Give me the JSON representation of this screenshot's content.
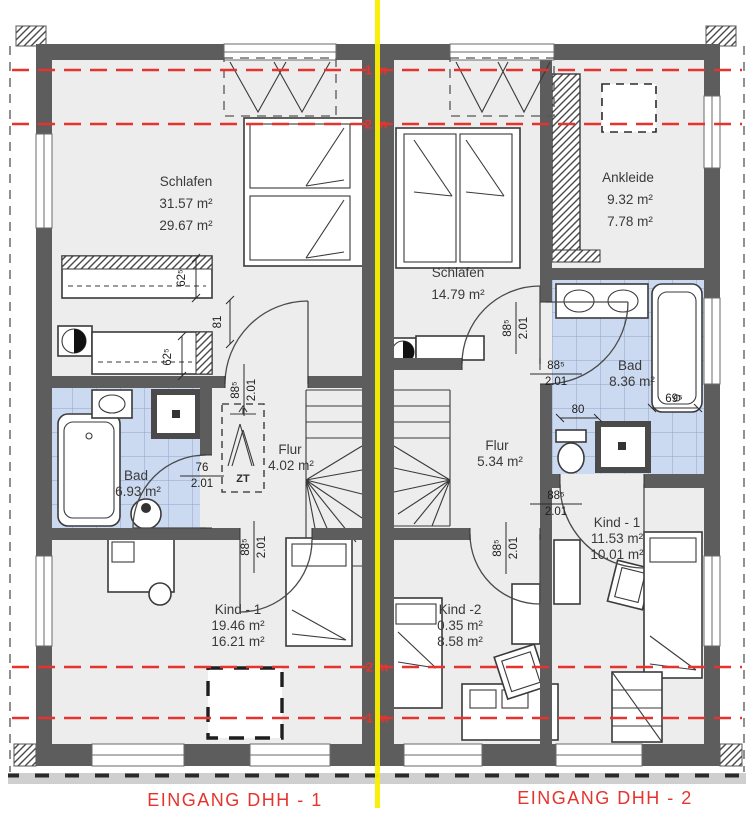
{
  "captions": {
    "left": "EINGANG  DHH - 1",
    "right": "EINGANG  DHH - 2"
  },
  "rooms": {
    "schlafen1": {
      "name": "Schlafen",
      "line2": "31.57 m²",
      "line3": "29.67 m²"
    },
    "ankleide": {
      "name": "Ankleide",
      "line2": "9.32 m²",
      "line3": "7.78 m²"
    },
    "schlafen2": {
      "name": "Schlafen",
      "line2": "14.79 m²"
    },
    "bad1": {
      "name": "Bad",
      "line2": "6.93 m²"
    },
    "bad2": {
      "name": "Bad",
      "line2": "8.36 m²"
    },
    "flur1": {
      "name": "Flur",
      "line2": "4.02 m²"
    },
    "flur2": {
      "name": "Flur",
      "line2": "5.34 m²"
    },
    "kind1_left": {
      "name": "Kind - 1",
      "line2": "19.46 m²",
      "line3": "16.21 m²"
    },
    "kind2": {
      "name": "Kind -2",
      "line2": "0.35 m²",
      "line3": "8.58 m²"
    },
    "kind1_right": {
      "name": "Kind  - 1",
      "line2": "11.53 m²",
      "line3": "10.01 m²"
    }
  },
  "dims": {
    "schlafen1_door": {
      "a": "88⁵",
      "b": "2.01"
    },
    "kind1l_door": {
      "a": "88⁵",
      "b": "2.01"
    },
    "bad1_door": {
      "a": "76",
      "b": "2.01"
    },
    "wall_81": "81",
    "wardrobe1_62": "62⁵",
    "wardrobe2_62": "62⁵",
    "schlafen2_door": {
      "a": "88⁵",
      "b": "2.01"
    },
    "bad2_door": {
      "a": "88⁵",
      "b": "2.01"
    },
    "bad2_80": "80",
    "bad2_69": "69⁵",
    "kind1r_door": {
      "a": "88⁵",
      "b": "2.01"
    },
    "kind2_door": {
      "a": "88⁵",
      "b": "2.01"
    }
  },
  "height_marks": {
    "top_1m": "1 m",
    "top_2m": "2 m",
    "bottom_2m": "2 m",
    "bottom_1m": "1 m"
  },
  "symbols": {
    "attic_ladder": "ZT"
  },
  "colors": {
    "red": "#e5342e",
    "yellow": "#f8ee00",
    "wall_gray": "#5d5d5d",
    "tile_blue": "#ccdaf1",
    "floor_gray": "#ededed"
  }
}
